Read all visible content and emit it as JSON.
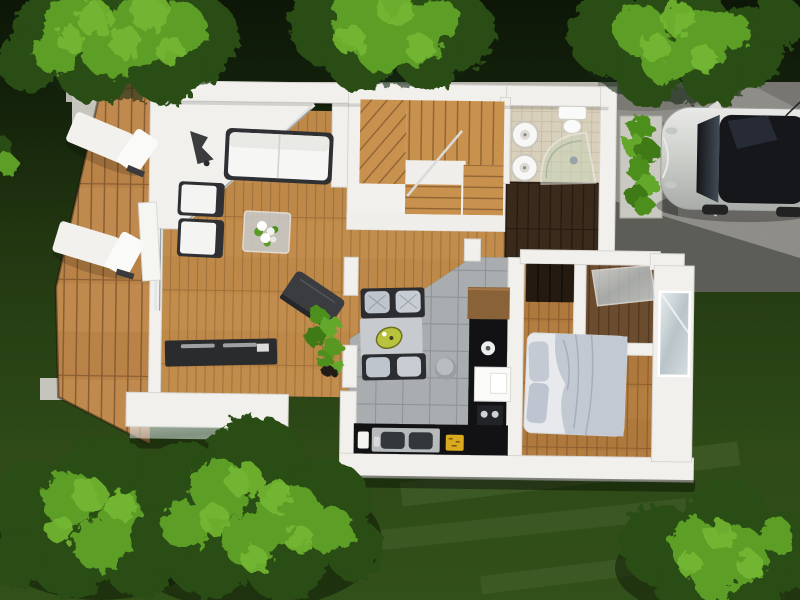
{
  "scene": {
    "kind": "aerial-3d-floor-plan-render",
    "inventory": {
      "exterior": [
        "lawn",
        "trees",
        "wood-deck",
        "sun-loungers",
        "concrete-driveway",
        "parked-car",
        "hedge-planter",
        "glass-balustrade",
        "entry-porch"
      ],
      "living_room": [
        "white-sofa",
        "armchair",
        "armchair",
        "glass-coffee-table",
        "flower-arrangement",
        "floor-lamp",
        "media-console"
      ],
      "lounge_area": [
        "modular-sofa",
        "serving-tray",
        "pouf",
        "dark-side-table",
        "potted-climber"
      ],
      "kitchen": [
        "upper-cabinet",
        "black-counter",
        "double-sink",
        "fridge",
        "coffee-machine",
        "fruit-bowl",
        "light-switch",
        "white-bowl"
      ],
      "bathroom": [
        "round-sink",
        "round-sink",
        "toilet",
        "corner-shower"
      ],
      "staircase": [
        "upper-flight",
        "landing",
        "lower-flight"
      ],
      "hallway": [
        "dark-wood-floor",
        "wardrobe"
      ],
      "bedroom": [
        "double-bed",
        "pillows",
        "blanket",
        "window"
      ]
    }
  },
  "palette": {
    "lawn_top": "#111d0a",
    "lawn_bottom": "#3f6520",
    "tree_dark": "#2a4d12",
    "tree_mid": "#5d9e27",
    "tree_bright": "#74b832",
    "hedge": "#4e8f1f",
    "plant_green": "#589822",
    "concrete": "#b7b6af",
    "concrete_pad": "#c6c5bd",
    "wall": "#f1f0ec",
    "deck_wood": "#c08a4e",
    "deck_gap": "#8a5d33",
    "living_wood": "#c28d4c",
    "living_gap": "#9c6f3a",
    "stair_wood": "#c9914e",
    "stair_gap": "#8f6434",
    "bedroom_wood": "#b57e41",
    "bedroom_gap": "#8a5c2d",
    "hall_wood": "#3a2a1c",
    "hall_gap": "#241810",
    "porch_wood": "#6b4c2e",
    "porch_gap": "#4a3320",
    "tile": "#a9adb0",
    "tile_grout": "#8f9397",
    "bath_tile": "#d9d0bc",
    "bath_grout": "#c3b9a2",
    "counter": "#19191c",
    "cabinet": "#8a6238",
    "sofa_frame": "#2f3033",
    "sofa_cushion": "#f6f6f4",
    "lounge_base": "#2c2d30",
    "lounge_cushion": "#bfc5cd",
    "lounge_seat": "#c7cace",
    "console": "#2a2b2d",
    "bed_linen": "#e7e9ec",
    "bed_pillow": "#c4cad4",
    "bed_blanket": "#c3c9d3",
    "car_body": "#d2d3d0",
    "car_glass": "#15171b",
    "accent_fruit": "#d9a91e",
    "accent_tray": "#b9c23c"
  }
}
